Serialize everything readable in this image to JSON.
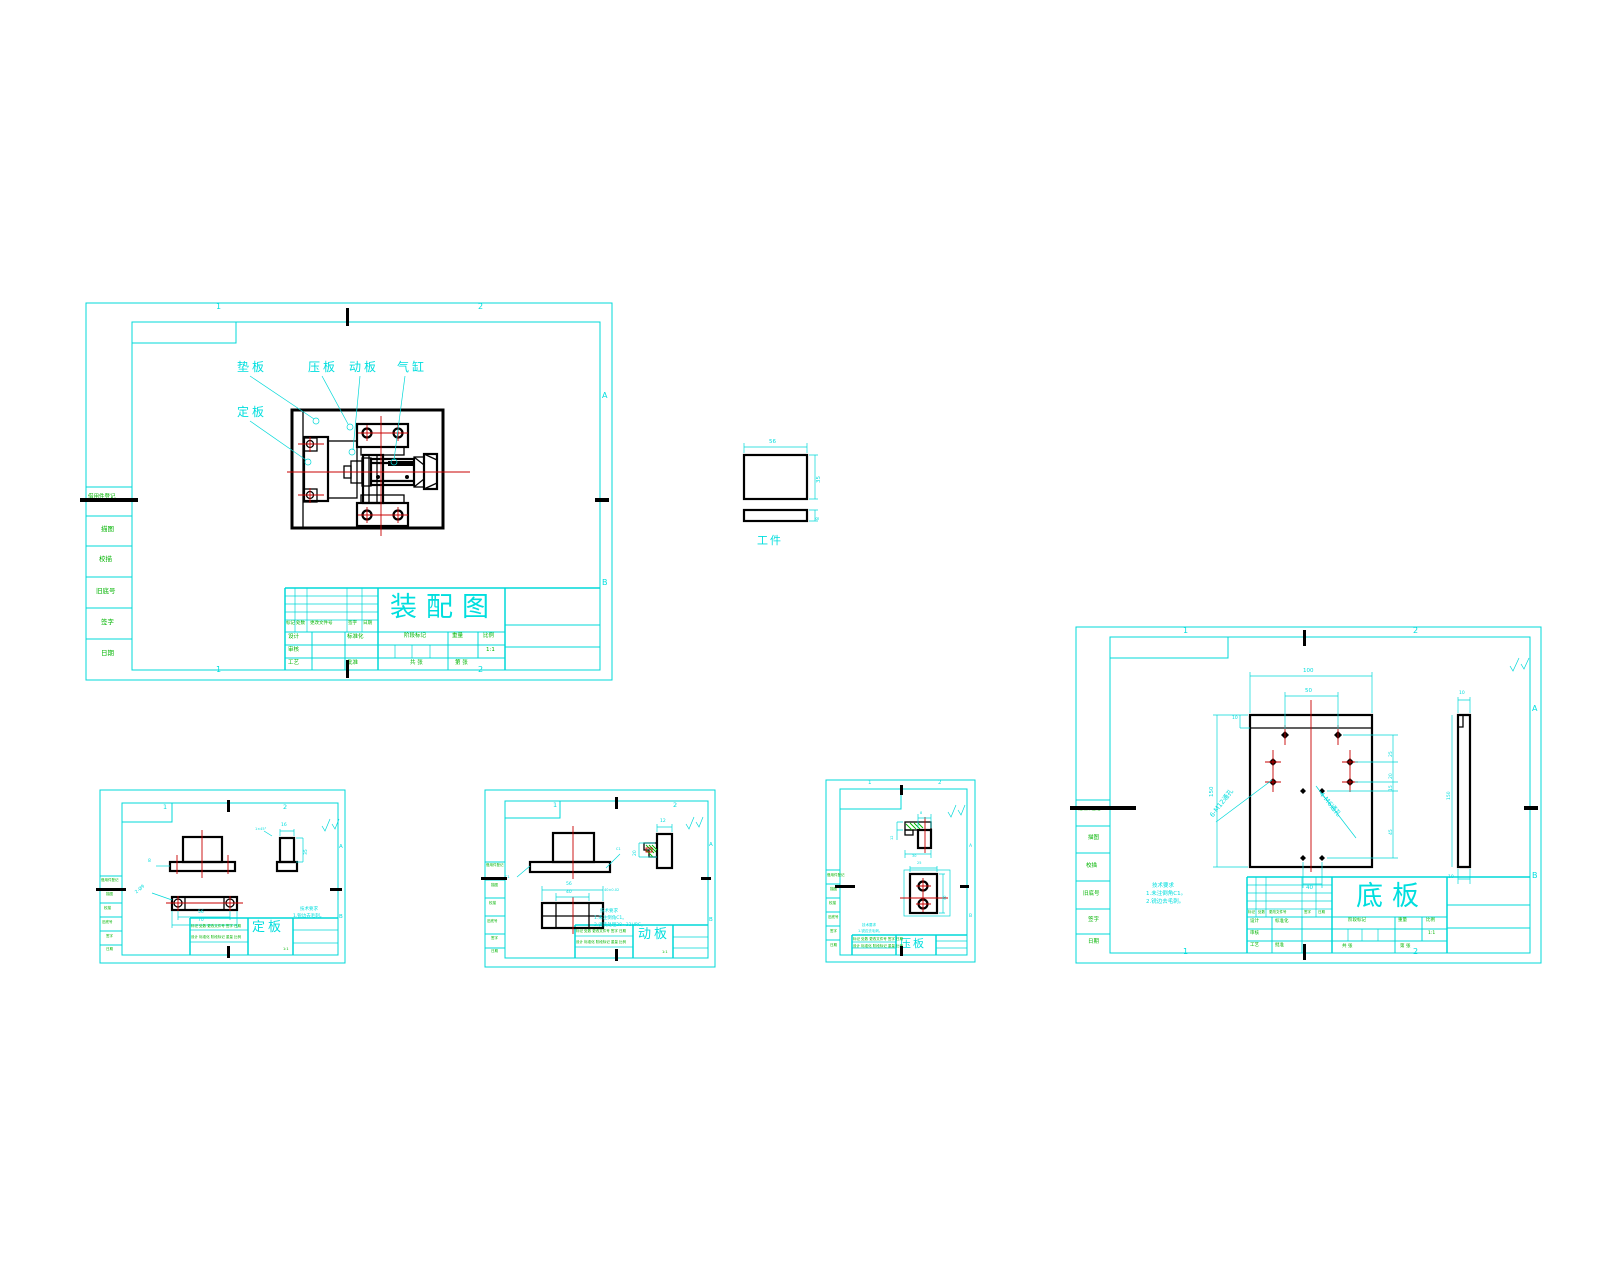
{
  "frame": {
    "z1": "1",
    "z2": "2",
    "ra": "A",
    "rb": "B"
  },
  "strip": {
    "borrow": "借用件登记",
    "trace": "描图",
    "proof": "校描",
    "oldno": "旧底号",
    "sign": "签字",
    "date": "日期"
  },
  "tb": {
    "mark": "标记",
    "qty": "处数",
    "doc": "更改文件号",
    "sign": "签字",
    "date": "日期",
    "design": "设计",
    "std": "标准化",
    "stage": "阶段标记",
    "weight": "重量",
    "scale": "比例",
    "ratio": "1:1",
    "audit": "审核",
    "craft": "工艺",
    "approve": "批准",
    "total": "共 张",
    "page": "第 张",
    "mini1": "标记 处数 更改文件号 签字 日期",
    "mini2": "设计 标准化 阶段标记 重量 比例"
  },
  "assembly": {
    "title": "装配图",
    "c1": "垫板",
    "c2": "压板",
    "c3": "动板",
    "c4": "气缸",
    "c5": "定板"
  },
  "workpiece": {
    "label": "工件",
    "w": "56",
    "h": "35",
    "t": "8"
  },
  "base": {
    "title": "底板",
    "lead1": "6-M12通孔",
    "lead2": "4-M6通孔",
    "w": "100",
    "win": "50",
    "h": "150",
    "band": "10",
    "bot": "40",
    "r1": "25",
    "r2": "20",
    "r3": "15",
    "r4": "45",
    "st": "10",
    "sh": "150",
    "n1": "技术要求",
    "n2": "1.未注倒角C1。",
    "n3": "2.锐边去毛刺。"
  },
  "ding": {
    "title": "定板",
    "lead": "2-Ø9",
    "w1": "56",
    "w2": "70",
    "h": "35",
    "t": "16",
    "fl": "8",
    "ch": "1×45°",
    "n1": "技术要求",
    "n2": "1.锐边去毛刺。"
  },
  "dong": {
    "title": "动板",
    "w": "56",
    "win": "40",
    "t": "12",
    "step": "20",
    "fit": "40±0.02",
    "ch": "C1",
    "n1": "技术要求",
    "n2": "1.未注倒角C1。",
    "n3": "2.调质处理28~32HRC。"
  },
  "ya": {
    "title": "压板",
    "w": "25",
    "h": "40",
    "t": "12",
    "step": "8",
    "b": "30",
    "n1": "技术要求",
    "n2": "1.锐边去毛刺。"
  }
}
